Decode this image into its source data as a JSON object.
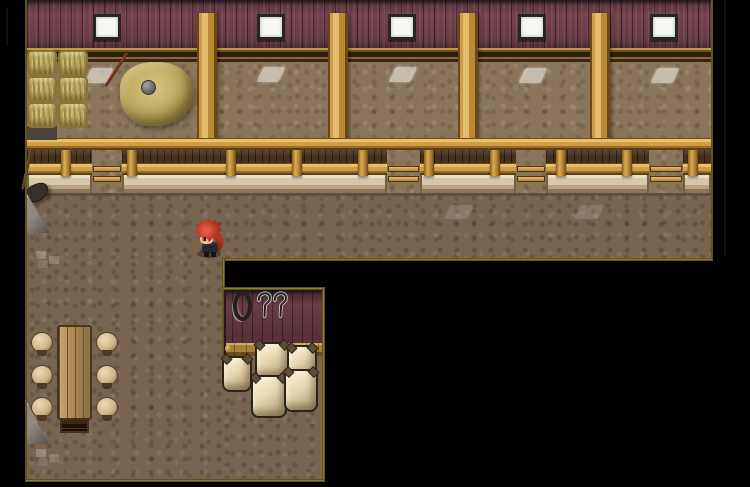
{
  "scene": {
    "type": "game-screenshot",
    "setting": "top-down 2D RPG tilemap of a barn / stable interior",
    "visible_text": "",
    "player": {
      "description": "small character sprite with spiky red hair and dark clothes, standing on the dirt floor facing left"
    },
    "rooms": {
      "stable_hall": "upper band with maroon plank wall, five windows, four wooden pillars and a stall fence with gate openings",
      "main_floor": "left column with a long wooden table and six round stools",
      "storage_nook": "small lower room with maroon wall, hanging rope coil, two sickles and stacked grain sacks"
    },
    "objects": {
      "windows": 5,
      "wall_pillars": 4,
      "fence_gate_openings": 4,
      "hay_bales": 6,
      "haystacks": 1,
      "pitchfork_in_haystack": 1,
      "rake_leaning_on_wall": 1,
      "tables": 1,
      "stools": 6,
      "grain_sacks": 5,
      "rope_coils": 1,
      "sickles": 2
    },
    "palette": {
      "background_black": "#000000",
      "wall_maroon": "#74424d",
      "wood_tan": "#c89d4c",
      "dirt_wall": "#8b755a",
      "dirt_floor": "#796450",
      "stone_ledge": "#d6c8a8",
      "hay": "#c2ab62",
      "sack_cream": "#e6d8b2",
      "map_border_gold": "#8d7b2f",
      "player_hair_red": "#c13c28"
    }
  }
}
